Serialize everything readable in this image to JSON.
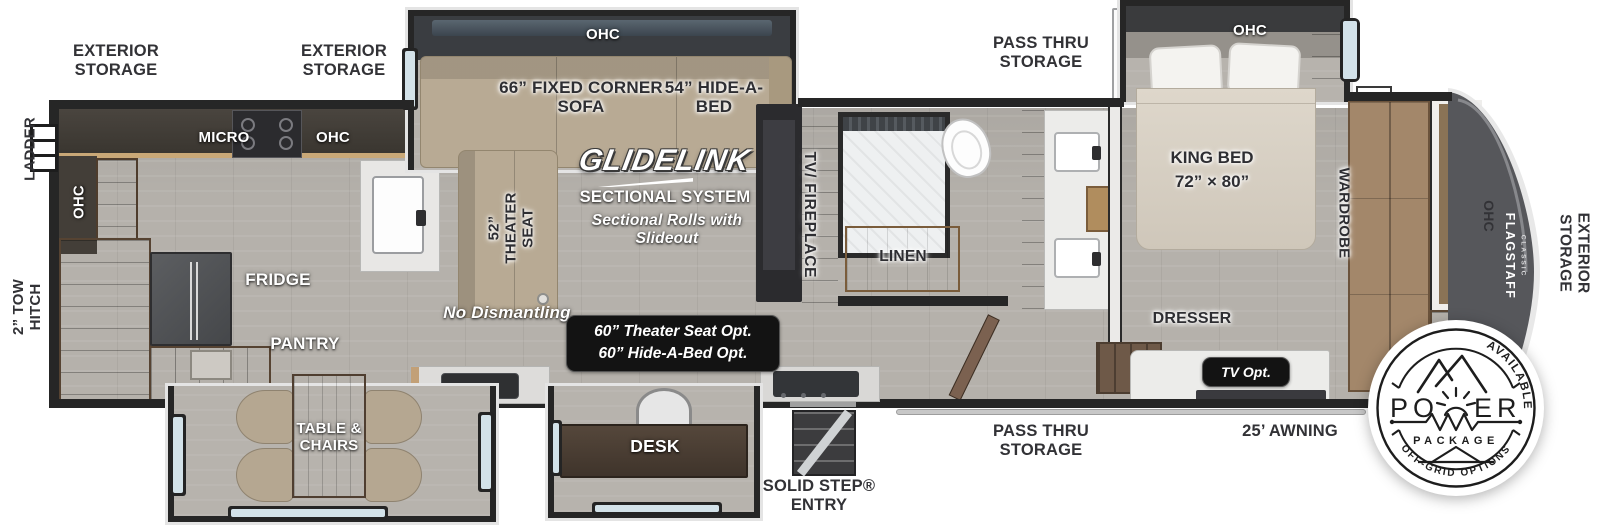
{
  "labels": {
    "tow_hitch": "2” TOW HITCH",
    "ladder": "LADDER",
    "ext_storage_1": "EXTERIOR STORAGE",
    "ext_storage_2": "EXTERIOR STORAGE",
    "ohc_left_wall": "OHC",
    "micro": "MICRO",
    "ohc_kitchen": "OHC",
    "fridge": "FRIDGE",
    "pantry": "PANTRY",
    "table_chairs": "TABLE & CHAIRS",
    "ohc_sofa": "OHC",
    "fixed_sofa": "66” FIXED CORNER SOFA",
    "hide_a_bed": "54” HIDE-A-BED",
    "theater_seat": "52” THEATER SEAT",
    "glidelink": "GLIDELINK",
    "sectional_system": "SECTIONAL SYSTEM",
    "sectional_note": "Sectional Rolls with Slideout",
    "tv_fireplace": "TV/ FIREPLACE",
    "linen": "LINEN",
    "no_dismantling": "No Dismantling",
    "option_line1": "60” Theater Seat Opt.",
    "option_line2": "60” Hide-A-Bed Opt.",
    "desk": "DESK",
    "solid_step_entry": "SOLID STEP® ENTRY",
    "pass_thru_top": "PASS THRU STORAGE",
    "ohc_bedroom": "OHC",
    "king_bed": "KING BED",
    "king_bed_size": "72” × 80”",
    "wardrobe": "WARDROBE",
    "dresser": "DRESSER",
    "tv_opt": "TV Opt.",
    "pass_thru_bottom": "PASS THRU STORAGE",
    "awning": "25’ AWNING",
    "ohc_front": "OHC",
    "flagstaff": "FLAGSTAFF",
    "flagstaff_sub": "CLASSIC",
    "ext_storage_right": "EXTERIOR STORAGE"
  },
  "power_badge": {
    "top_arc": "AVAILABLE WITH",
    "word_left": "PO",
    "word_right": "ER",
    "package": "PACKAGE",
    "bottom_arc": "OFF-GRID OPTIONS"
  },
  "colors": {
    "wall": "#262626",
    "floor": "#b5b1ab",
    "sofa_tan": "#b8aa94",
    "cabinet_wood": "#8b7463",
    "linen_wood": "#d0a672",
    "front_cap": "#56575b",
    "badge_black": "#131313"
  }
}
